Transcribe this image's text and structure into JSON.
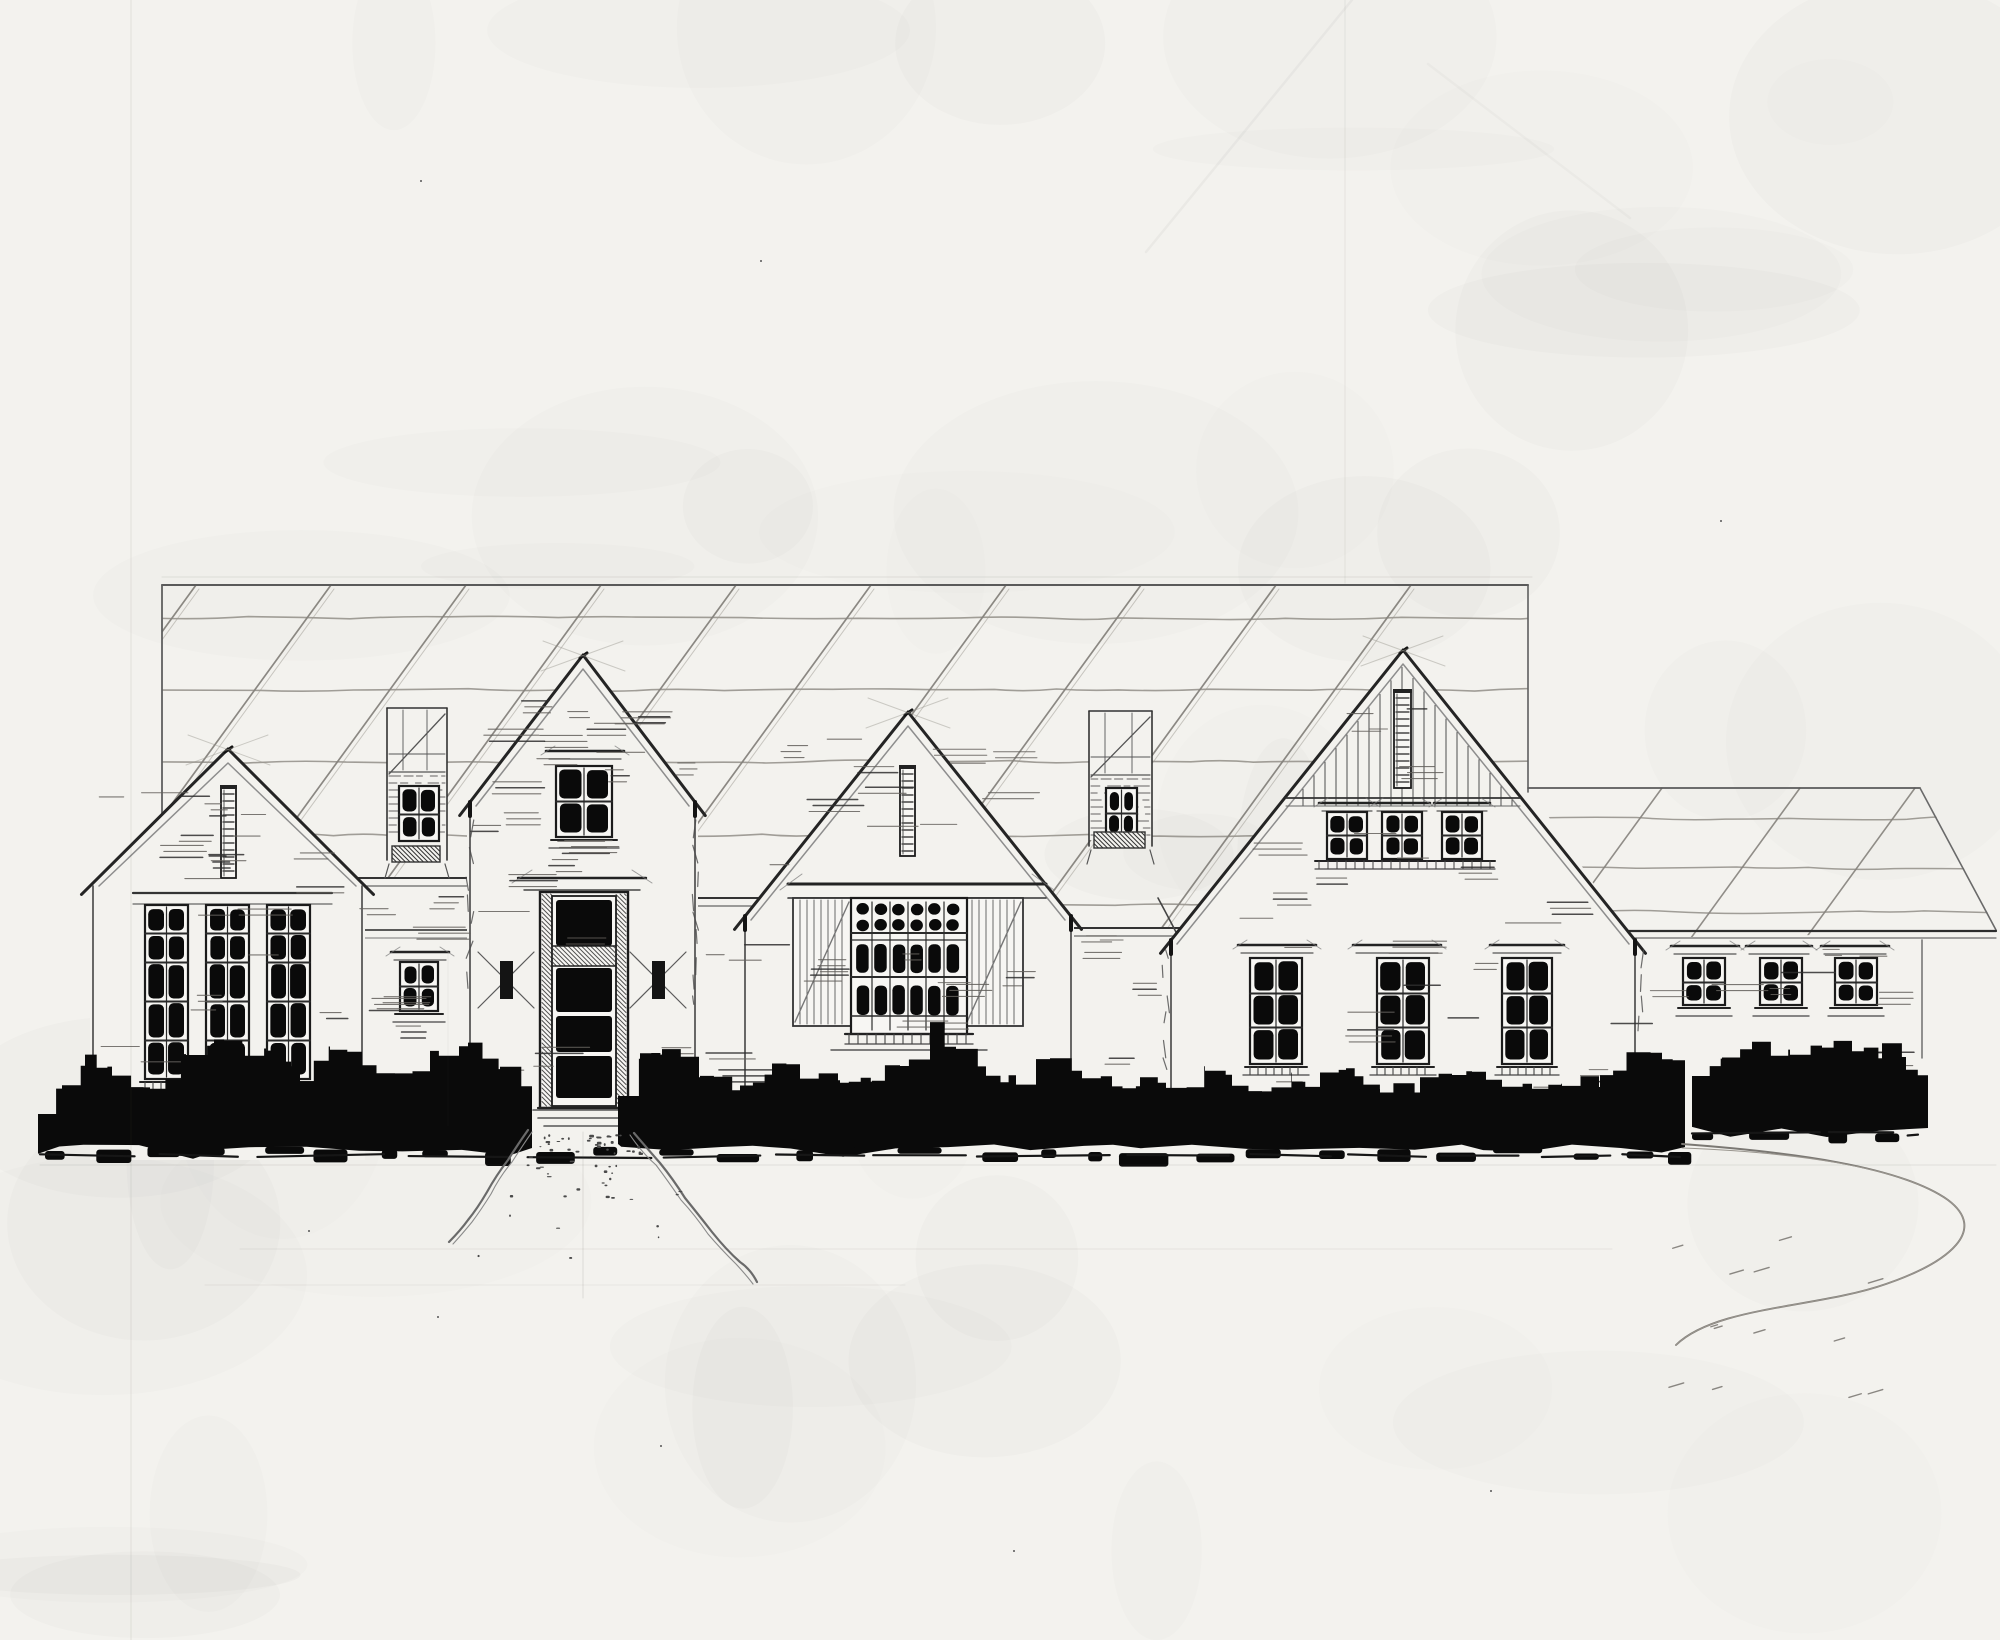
{
  "title": "",
  "colors": {
    "paper": "#f3f2ee",
    "paper_light": "#f7f6f3",
    "ink": "#1b1b1b",
    "dark": "#0a0a0a",
    "mid": "#3f3f3f",
    "soft": "#6b6b6b",
    "pencil": "#97938d",
    "edge": "#242424"
  },
  "scene": {
    "canvas": {
      "w": 2000,
      "h": 1640
    },
    "roof": {
      "top": 585,
      "left": 162,
      "right": 1528,
      "clip": [
        [
          162,
          585
        ],
        [
          1528,
          585
        ],
        [
          1528,
          800
        ],
        [
          1180,
          944
        ],
        [
          1060,
          915
        ],
        [
          760,
          912
        ],
        [
          695,
          906
        ],
        [
          472,
          886
        ],
        [
          358,
          886
        ],
        [
          162,
          940
        ]
      ],
      "hatch_x": [
        196,
        331,
        466,
        601,
        736,
        871,
        1006,
        1141,
        1276,
        1411
      ],
      "hatch_len": 430,
      "wavy_y": [
        618,
        690,
        762,
        835,
        905
      ],
      "top_double_y": 577
    },
    "wing": {
      "clip": [
        [
          1528,
          786
        ],
        [
          1920,
          786
        ],
        [
          1998,
          932
        ],
        [
          1630,
          938
        ]
      ],
      "top": [
        1528,
        788,
        1920,
        788
      ],
      "hip": [
        1920,
        788,
        1996,
        930
      ],
      "fascia": [
        1628,
        931,
        1996,
        931
      ],
      "fascia2": [
        1633,
        938,
        1996,
        938
      ],
      "hatch_x": [
        1662,
        1800,
        1915
      ],
      "wavy_y": [
        818,
        868,
        912
      ],
      "wall_right": [
        1922,
        940,
        1922,
        1058
      ]
    },
    "bays": [
      {
        "name": "bay-left",
        "x": 356,
        "x2": 474,
        "fascia": [
          878,
          886
        ],
        "band": [
          363,
          470,
          930,
          938
        ],
        "bottom": 1150
      },
      {
        "name": "bay-center",
        "x": 690,
        "x2": 766,
        "fascia": [
          898,
          906
        ],
        "bottom": 1150
      },
      {
        "name": "bay-right",
        "x": 1064,
        "x2": 1180,
        "fascia": [
          928,
          936
        ],
        "valley": [
          1158,
          898,
          1180,
          940
        ],
        "bottom": 1150
      }
    ],
    "gables": [
      {
        "name": "left-gable",
        "apex": [
          228,
          749
        ],
        "left": [
          90,
          886
        ],
        "right": [
          365,
          886
        ],
        "wallBottom": 1120
      },
      {
        "name": "entry-tower",
        "apex": [
          583,
          655
        ],
        "left": [
          467,
          806
        ],
        "right": [
          698,
          806
        ],
        "wallBottom": 1120,
        "tick": true
      },
      {
        "name": "center-gable",
        "apex": [
          908,
          712
        ],
        "left": [
          742,
          920
        ],
        "right": [
          1074,
          920
        ],
        "wallBottom": 1110,
        "tick": true
      },
      {
        "name": "right-gable",
        "apex": [
          1403,
          650
        ],
        "left": [
          1168,
          944
        ],
        "right": [
          1638,
          944
        ],
        "wallBottom": 1090,
        "tick": true
      }
    ],
    "left_gable_band": [
      133,
      332,
      893,
      904
    ],
    "boards": {
      "apex": [
        1403,
        650
      ],
      "slope": 1.232,
      "x1": 1292,
      "x2": 1516,
      "step": 11,
      "yBot": 806,
      "band": [
        1286,
        1520,
        798,
        806
      ]
    },
    "louvers": [
      {
        "name": "left-gable-louver",
        "x": 221,
        "y": 788,
        "w": 15,
        "h": 90
      },
      {
        "name": "center-gable-louver",
        "x": 900,
        "y": 768,
        "w": 15,
        "h": 88
      },
      {
        "name": "right-gable-louver",
        "x": 1394,
        "y": 692,
        "w": 17,
        "h": 96
      }
    ],
    "windows": [
      {
        "name": "left-gable-window-1",
        "x": 145,
        "y": 905,
        "w": 43,
        "rows": [
          24,
          26,
          36,
          36,
          34
        ],
        "sill": true,
        "brackets": true
      },
      {
        "name": "left-gable-window-2",
        "x": 206,
        "y": 905,
        "w": 43,
        "rows": [
          24,
          26,
          36,
          36,
          34
        ],
        "sill": true,
        "brackets": true
      },
      {
        "name": "left-gable-window-3",
        "x": 267,
        "y": 905,
        "w": 43,
        "rows": [
          24,
          26,
          36,
          36,
          34
        ],
        "sill": true,
        "brackets": true
      },
      {
        "name": "entry-bay-window",
        "x": 400,
        "y": 962,
        "w": 38,
        "rows": [
          20,
          20
        ],
        "head": [
          391,
          449,
          952
        ],
        "sill": true
      },
      {
        "name": "tower-window",
        "x": 556,
        "y": 766,
        "w": 56,
        "rows": [
          31,
          31
        ],
        "head": [
          546,
          624,
          751
        ],
        "sill": true
      },
      {
        "name": "right-gable-upper-window-1",
        "x": 1327,
        "y": 812,
        "w": 40,
        "rows": [
          19,
          19
        ],
        "head": [
          1319,
          1375,
          803
        ]
      },
      {
        "name": "right-gable-upper-window-2",
        "x": 1382,
        "y": 812,
        "w": 40,
        "rows": [
          19,
          19
        ],
        "head": [
          1374,
          1430,
          803
        ]
      },
      {
        "name": "right-gable-upper-window-3",
        "x": 1442,
        "y": 812,
        "w": 40,
        "rows": [
          19,
          19
        ],
        "head": [
          1434,
          1490,
          803
        ]
      },
      {
        "name": "right-gable-lower-window-1",
        "x": 1250,
        "y": 958,
        "w": 52,
        "rows": [
          31,
          31,
          32
        ],
        "head": [
          1238,
          1316,
          945
        ],
        "sill": true,
        "brackets": true
      },
      {
        "name": "right-gable-lower-window-2",
        "x": 1377,
        "y": 958,
        "w": 52,
        "rows": [
          31,
          31,
          32
        ],
        "head": [
          1353,
          1441,
          945
        ],
        "sill": true,
        "brackets": true
      },
      {
        "name": "right-gable-lower-window-3",
        "x": 1502,
        "y": 958,
        "w": 50,
        "rows": [
          31,
          31,
          32
        ],
        "head": [
          1490,
          1564,
          945
        ],
        "sill": true,
        "brackets": true
      },
      {
        "name": "wing-window-1",
        "x": 1683,
        "y": 958,
        "w": 42,
        "rows": [
          20,
          18
        ],
        "head": [
          1671,
          1739,
          946
        ],
        "sill": true
      },
      {
        "name": "wing-window-2",
        "x": 1760,
        "y": 958,
        "w": 42,
        "rows": [
          20,
          18
        ],
        "head": [
          1746,
          1812,
          946
        ],
        "sill": true
      },
      {
        "name": "wing-window-3",
        "x": 1835,
        "y": 958,
        "w": 42,
        "rows": [
          20,
          18
        ],
        "head": [
          1821,
          1889,
          946
        ],
        "sill": true
      }
    ],
    "right_gable_upper_sill": [
      1315,
      1495,
      861,
      869
    ],
    "grid_window": {
      "x": 851,
      "y": 898,
      "w": 116,
      "h": 136,
      "cols": 6,
      "header": [
        788,
        1046,
        884,
        898
      ],
      "sill": [
        845,
        973,
        1034,
        1044
      ],
      "subsill": [
        831,
        987,
        1050
      ]
    },
    "shutters": [
      {
        "x": 793,
        "y": 898,
        "w": 58,
        "h": 128
      },
      {
        "x": 965,
        "y": 898,
        "w": 58,
        "h": 128
      }
    ],
    "dormers": [
      {
        "name": "left-dormer",
        "x": 387,
        "y": 708,
        "w": 60,
        "h": 162,
        "win": {
          "x": 399,
          "y": 786,
          "w": 40,
          "rows": [
            24,
            22
          ]
        }
      },
      {
        "name": "right-dormer",
        "x": 1089,
        "y": 711,
        "w": 63,
        "h": 145,
        "win": {
          "x": 1106,
          "y": 788,
          "w": 31,
          "rows": [
            21,
            19
          ]
        }
      }
    ],
    "door": {
      "header": [
        518,
        646,
        878,
        890
      ],
      "frame": [
        540,
        892,
        88,
        216
      ],
      "slab": [
        552,
        896,
        64,
        210
      ],
      "panels": [
        [
          556,
          900,
          56,
          46
        ],
        [
          556,
          968,
          56,
          44
        ],
        [
          556,
          1016,
          56,
          36
        ],
        [
          556,
          1056,
          56,
          42
        ]
      ],
      "transom": [
        552,
        946,
        64,
        20
      ],
      "steps": [
        [
          533,
          1110,
          645
        ],
        [
          538,
          1118,
          640
        ],
        [
          544,
          1126,
          634
        ]
      ]
    },
    "sconces": [
      {
        "cx": 506,
        "cy": 980
      },
      {
        "cx": 658,
        "cy": 980
      }
    ],
    "bushes": [
      {
        "name": "shrub-band-left",
        "bottom": 1148,
        "seed": 3,
        "profile": [
          [
            38,
            1108
          ],
          [
            62,
            1092
          ],
          [
            85,
            1060
          ],
          [
            112,
            1076
          ],
          [
            150,
            1086
          ],
          [
            186,
            1058
          ],
          [
            214,
            1036
          ],
          [
            244,
            1056
          ],
          [
            266,
            1046
          ],
          [
            300,
            1076
          ],
          [
            330,
            1044
          ],
          [
            362,
            1062
          ],
          [
            395,
            1070
          ],
          [
            430,
            1058
          ],
          [
            468,
            1046
          ],
          [
            500,
            1072
          ],
          [
            532,
            1090
          ]
        ]
      },
      {
        "name": "shrub-band-center",
        "bottom": 1147,
        "seed": 4,
        "profile": [
          [
            618,
            1090
          ],
          [
            640,
            1060
          ],
          [
            662,
            1046
          ],
          [
            700,
            1072
          ],
          [
            740,
            1086
          ],
          [
            772,
            1066
          ],
          [
            800,
            1078
          ],
          [
            840,
            1082
          ],
          [
            872,
            1074
          ],
          [
            900,
            1066
          ],
          [
            930,
            1030
          ],
          [
            956,
            1048
          ],
          [
            986,
            1078
          ],
          [
            1016,
            1080
          ],
          [
            1050,
            1056
          ],
          [
            1082,
            1075
          ],
          [
            1112,
            1082
          ],
          [
            1140,
            1078
          ],
          [
            1166,
            1094
          ],
          [
            1205,
            1068
          ],
          [
            1232,
            1082
          ],
          [
            1262,
            1088
          ],
          [
            1292,
            1078
          ],
          [
            1320,
            1080
          ],
          [
            1346,
            1068
          ],
          [
            1380,
            1088
          ],
          [
            1420,
            1084
          ],
          [
            1452,
            1078
          ],
          [
            1472,
            1066
          ],
          [
            1502,
            1082
          ],
          [
            1532,
            1088
          ],
          [
            1562,
            1084
          ],
          [
            1600,
            1080
          ],
          [
            1636,
            1046
          ],
          [
            1662,
            1054
          ],
          [
            1685,
            1072
          ]
        ]
      },
      {
        "name": "shrub-band-right",
        "bottom": 1128,
        "seed": 5,
        "profile": [
          [
            1692,
            1070
          ],
          [
            1722,
            1056
          ],
          [
            1752,
            1046
          ],
          [
            1790,
            1058
          ],
          [
            1822,
            1044
          ],
          [
            1852,
            1056
          ],
          [
            1882,
            1050
          ],
          [
            1906,
            1062
          ],
          [
            1928,
            1090
          ]
        ]
      }
    ],
    "blob_rows": [
      {
        "x1": 45,
        "x2": 1680,
        "y": 1146,
        "seed": 8
      },
      {
        "x1": 1692,
        "x2": 1918,
        "y": 1126,
        "seed": 9
      }
    ],
    "ground_segs": [
      {
        "x1": 40,
        "x2": 1680,
        "y": 1156,
        "seed": 12
      },
      {
        "x1": 1692,
        "x2": 1918,
        "y": 1134,
        "seed": 13
      }
    ],
    "walkway": {
      "left": [
        [
          528,
          1130
        ],
        [
          508,
          1160
        ],
        [
          487,
          1192
        ],
        [
          468,
          1220
        ],
        [
          449,
          1242
        ]
      ],
      "right": [
        [
          634,
          1133
        ],
        [
          660,
          1163
        ],
        [
          685,
          1198
        ],
        [
          712,
          1232
        ],
        [
          740,
          1262
        ],
        [
          757,
          1282
        ]
      ],
      "stipple": {
        "seed": 11,
        "n": 62,
        "yTop": 1134,
        "yBot": 1268,
        "tl": 530,
        "bl": 450,
        "tr": 636,
        "br": 752
      }
    },
    "driveway": {
      "path": "M1682,1144 C1790,1152 1900,1166 1948,1200 C1988,1230 1950,1262 1886,1284 C1818,1308 1716,1306 1676,1345",
      "dashes": {
        "seed": 6,
        "n": 13,
        "x1": 1668,
        "x2": 1880,
        "y1": 1240,
        "y2": 1400
      }
    },
    "construction_lines": [
      [
        162,
        577,
        1532,
        577,
        0.12,
        1
      ],
      [
        40,
        1165,
        1996,
        1165,
        0.12,
        1
      ],
      [
        240,
        1249,
        1612,
        1249,
        0.09,
        1
      ],
      [
        205,
        1285,
        905,
        1285,
        0.08,
        1
      ],
      [
        131,
        0,
        131,
        1640,
        0.07,
        1.5
      ],
      [
        1345,
        0,
        1345,
        583,
        0.06,
        1.5
      ],
      [
        583,
        1132,
        583,
        1298,
        0.15,
        1
      ],
      [
        1352,
        0,
        1146,
        252,
        0.05,
        2.5
      ],
      [
        1428,
        64,
        1630,
        218,
        0.035,
        2.5
      ],
      [
        448,
        952,
        448,
        1126,
        0.06,
        1
      ]
    ],
    "apex_sketch": [
      [
        583,
        655
      ],
      [
        908,
        712
      ],
      [
        1403,
        650
      ],
      [
        228,
        749
      ]
    ],
    "textures": [
      {
        "r": [
          100,
          790,
          255,
          280
        ],
        "n": 16,
        "seed": 21
      },
      {
        "r": [
          150,
          792,
          160,
          95
        ],
        "n": 5,
        "seed": 22
      },
      {
        "r": [
          368,
          895,
          95,
          200
        ],
        "n": 6,
        "seed": 23
      },
      {
        "r": [
          476,
          700,
          215,
          380
        ],
        "n": 18,
        "seed": 24
      },
      {
        "r": [
          700,
          912,
          55,
          170
        ],
        "n": 4,
        "seed": 25
      },
      {
        "r": [
          752,
          742,
          310,
          285
        ],
        "n": 16,
        "seed": 26
      },
      {
        "r": [
          1080,
          935,
          85,
          190
        ],
        "n": 6,
        "seed": 27
      },
      {
        "r": [
          1180,
          818,
          450,
          300
        ],
        "n": 24,
        "seed": 28
      },
      {
        "r": [
          1330,
          700,
          150,
          90
        ],
        "n": 5,
        "seed": 29
      },
      {
        "r": [
          1640,
          948,
          275,
          120
        ],
        "n": 10,
        "seed": 30
      },
      {
        "r": [
          505,
          682,
          165,
          105
        ],
        "n": 6,
        "seed": 31
      },
      {
        "r": [
          835,
          735,
          150,
          115
        ],
        "n": 6,
        "seed": 32
      }
    ],
    "corner_tick_columns": [
      [
        1166,
        950,
        1070
      ],
      [
        1640,
        950,
        1040
      ],
      [
        470,
        820,
        1000
      ],
      [
        696,
        820,
        1000
      ]
    ],
    "dust": [
      [
        437,
        1316
      ],
      [
        660,
        1445
      ],
      [
        1013,
        1550
      ],
      [
        308,
        1230
      ],
      [
        1490,
        1490
      ],
      [
        760,
        260
      ],
      [
        420,
        180
      ],
      [
        1720,
        520
      ]
    ]
  }
}
